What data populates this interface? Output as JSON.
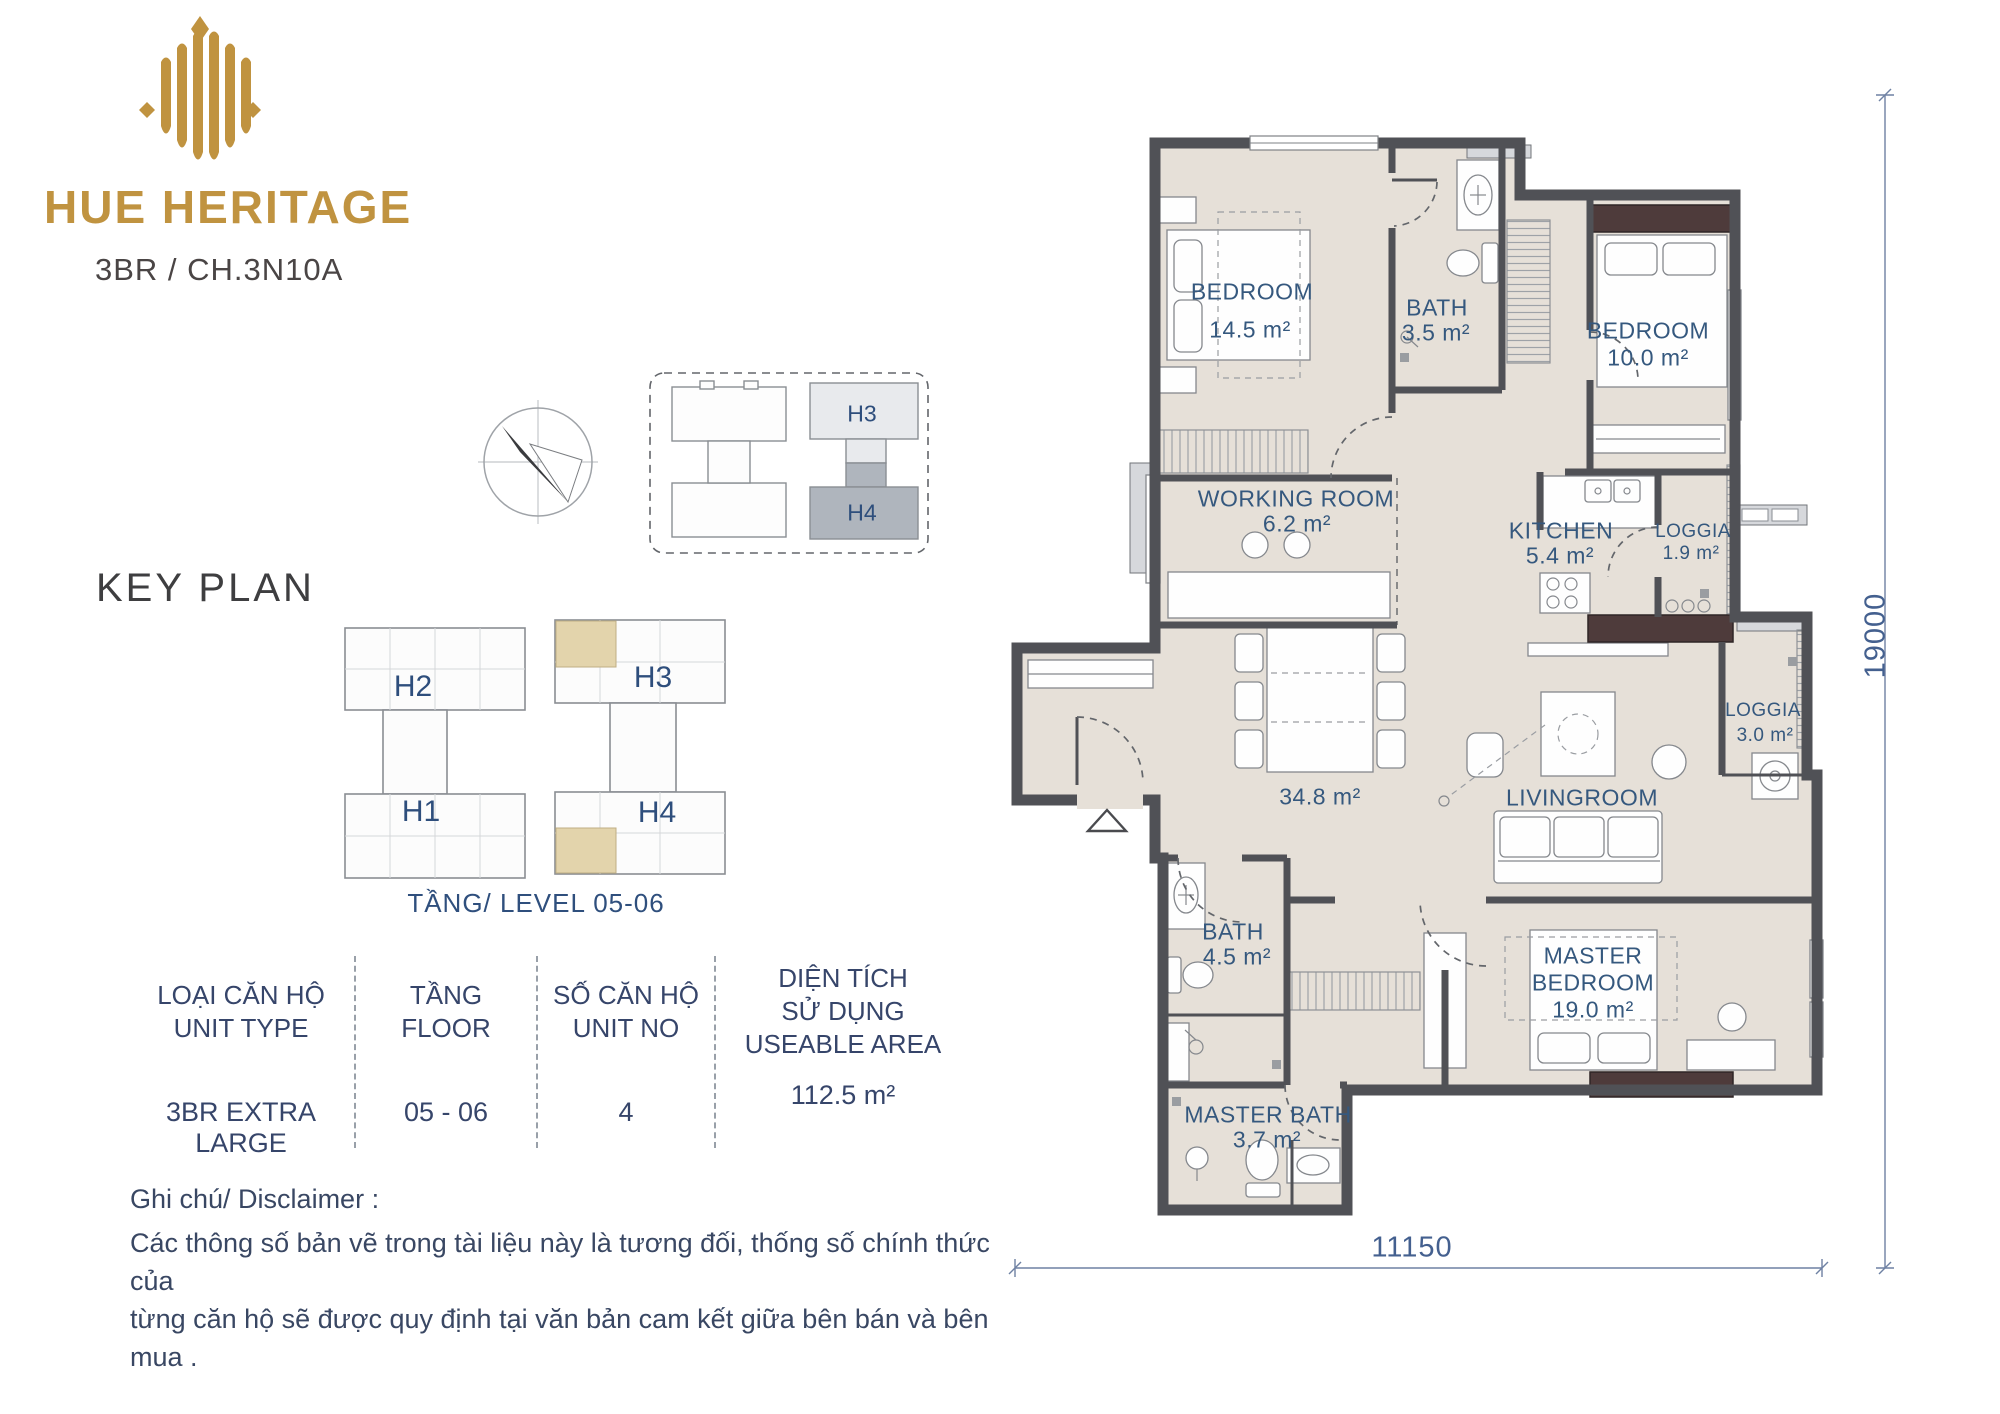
{
  "brand": {
    "logo_text": "HUE HERITAGE",
    "unit_code": "3BR / CH.3N10A"
  },
  "key_plan": {
    "title": "KEY PLAN",
    "level_caption": "TẦNG/ LEVEL 05-06",
    "mini": {
      "h3": "H3",
      "h4": "H4"
    },
    "main": {
      "h2": "H2",
      "h1": "H1",
      "h3": "H3",
      "h4": "H4"
    }
  },
  "spec_table": {
    "columns": [
      {
        "header": [
          "LOẠI CĂN HỘ",
          "UNIT TYPE"
        ],
        "value": "3BR EXTRA LARGE"
      },
      {
        "header": [
          "TẦNG",
          "FLOOR"
        ],
        "value": "05 - 06"
      },
      {
        "header": [
          "SỐ CĂN HỘ",
          "UNIT NO"
        ],
        "value": "4"
      },
      {
        "header": [
          "DIỆN TÍCH",
          "SỬ DỤNG",
          "USEABLE AREA"
        ],
        "value": "112.5 m²"
      }
    ]
  },
  "disclaimer": {
    "heading": "Ghi chú/ Disclaimer :",
    "line1": "Các thông số bản vẽ trong tài liệu này là tương đối, thống số chính thức của",
    "line2": "từng căn hộ sẽ được quy định tại văn bản cam kết giữa bên bán và bên mua ."
  },
  "floor_plan": {
    "rooms": {
      "bedroom1": {
        "name": "BEDROOM",
        "area": "14.5 m²"
      },
      "bath1": {
        "name": "BATH",
        "area": "3.5 m²"
      },
      "bedroom2": {
        "name": "BEDROOM",
        "area": "10.0 m²"
      },
      "working": {
        "name": "WORKING ROOM",
        "area": "6.2 m²"
      },
      "kitchen": {
        "name": "KITCHEN",
        "area": "5.4 m²"
      },
      "loggia1": {
        "name": "LOGGIA",
        "area": "1.9 m²"
      },
      "dining": {
        "area": "34.8 m²"
      },
      "living": {
        "name": "LIVINGROOM"
      },
      "loggia2": {
        "name": "LOGGIA",
        "area": "3.0 m²"
      },
      "bath2": {
        "name": "BATH",
        "area": "4.5 m²"
      },
      "master": {
        "name_l1": "MASTER",
        "name_l2": "BEDROOM",
        "area": "19.0 m²"
      },
      "master_bath": {
        "name": "MASTER BATH",
        "area": "3.7 m²"
      }
    },
    "dimensions": {
      "height": "19000",
      "width": "11150"
    }
  },
  "colors": {
    "brand_gold": "#C09340",
    "room_label_blue": "#35587E",
    "keyplan_navy": "#2E4E7C",
    "floor": "#E6E0D8",
    "wall": "#505156",
    "wardrobe_brown": "#4E3B3B",
    "highlight_tan": "#E3D4AC",
    "dimension_blue": "#44608F"
  }
}
